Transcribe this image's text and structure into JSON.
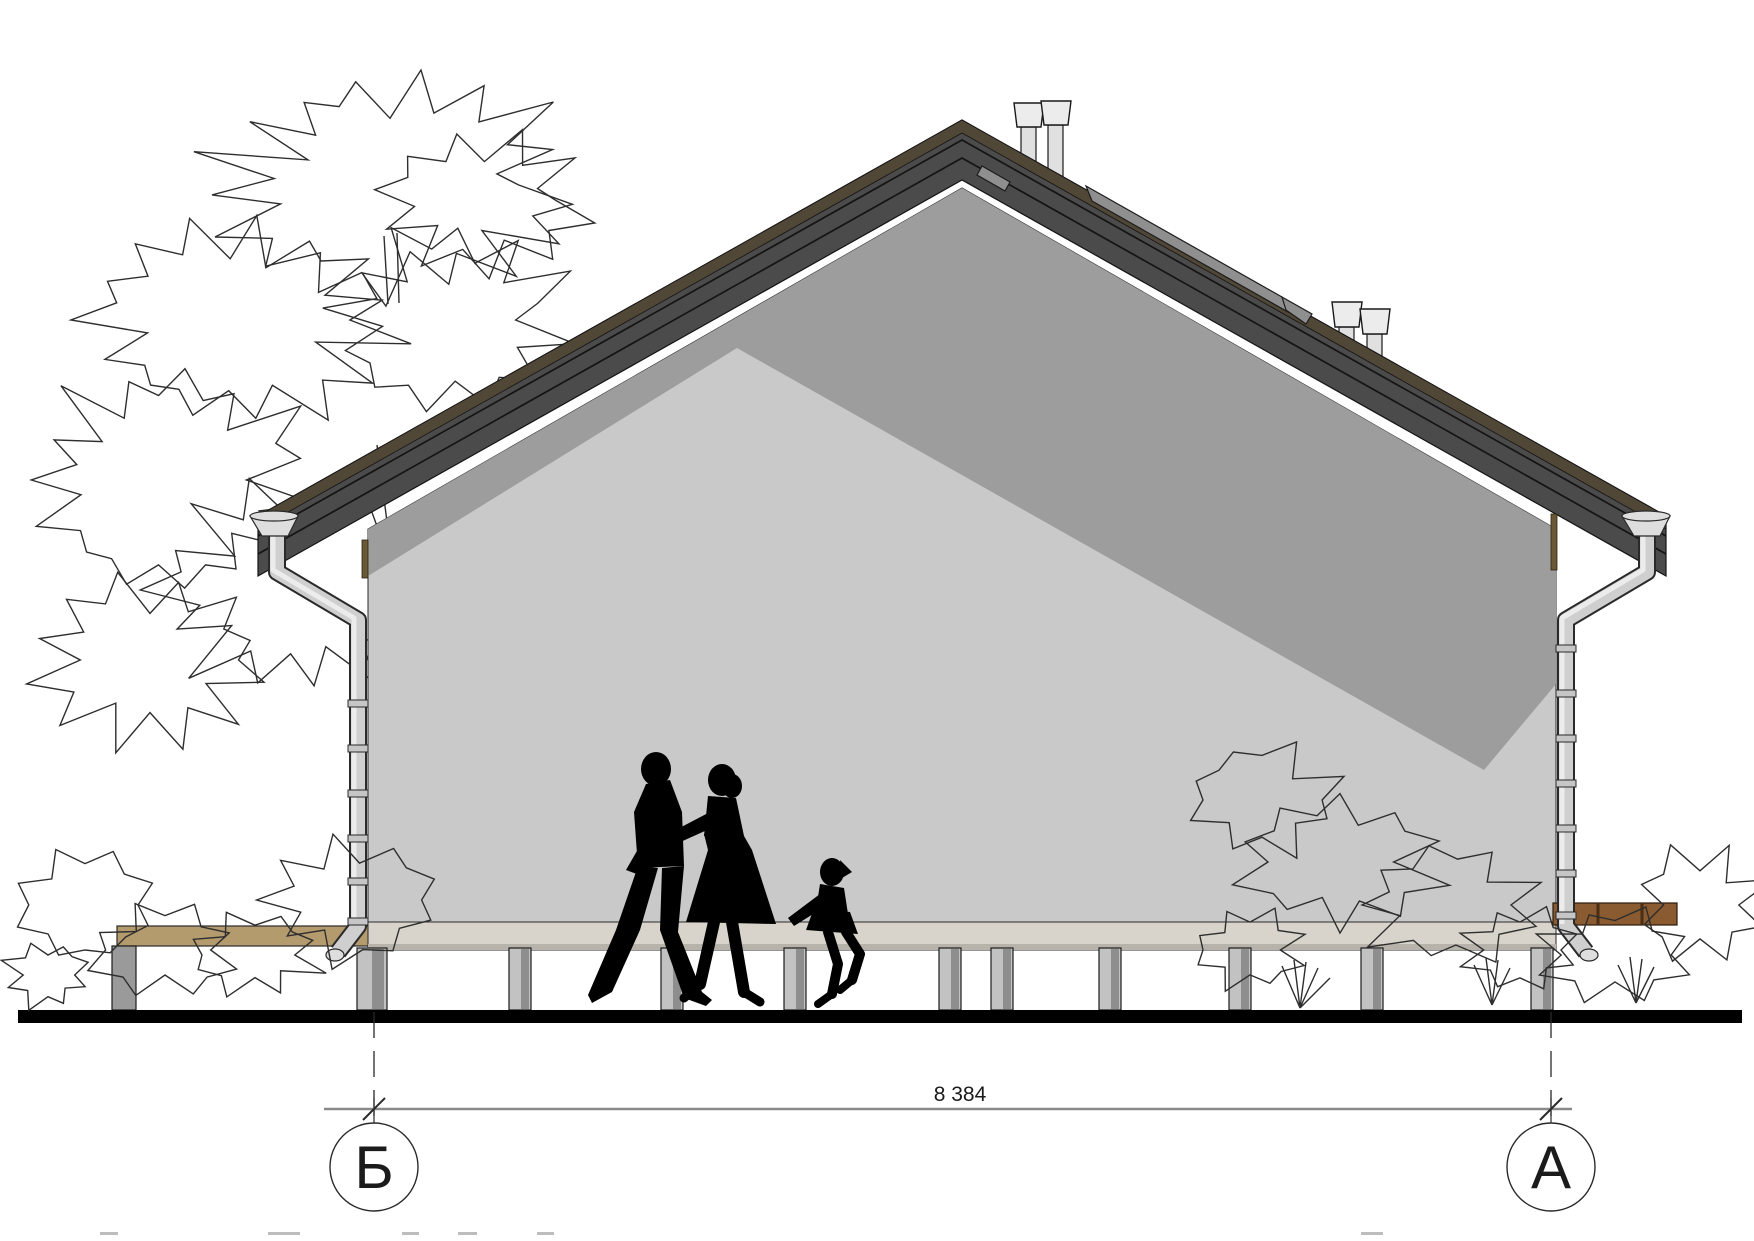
{
  "drawing": {
    "dimension_label": "8 384",
    "axis_left": "Б",
    "axis_right": "А"
  },
  "palette": {
    "roof_band": "#4b4b4b",
    "ridge_trim": "#514737",
    "wall_lit": "#c9c9c9",
    "wall_shadow": "#9d9d9d",
    "slab": "#d8d4cb",
    "slab_edge": "#b7b3aa",
    "deck": "#b49b6e",
    "beam_brown": "#8a5a30",
    "pile_light": "#c2c2c2",
    "pile_dark": "#8e8e8e",
    "metal_light": "#dedede",
    "ground": "#000000",
    "dimension_line": "#8a8a8a",
    "vegetation_line": "#2e2e2e",
    "silhouette": "#000000"
  },
  "icons": {
    "axis-marker": "circle-with-letter",
    "dimension-tick": "45deg-slash",
    "vent-pipe": "cone-capped-stack",
    "tree-outline": "jagged-cloud"
  }
}
